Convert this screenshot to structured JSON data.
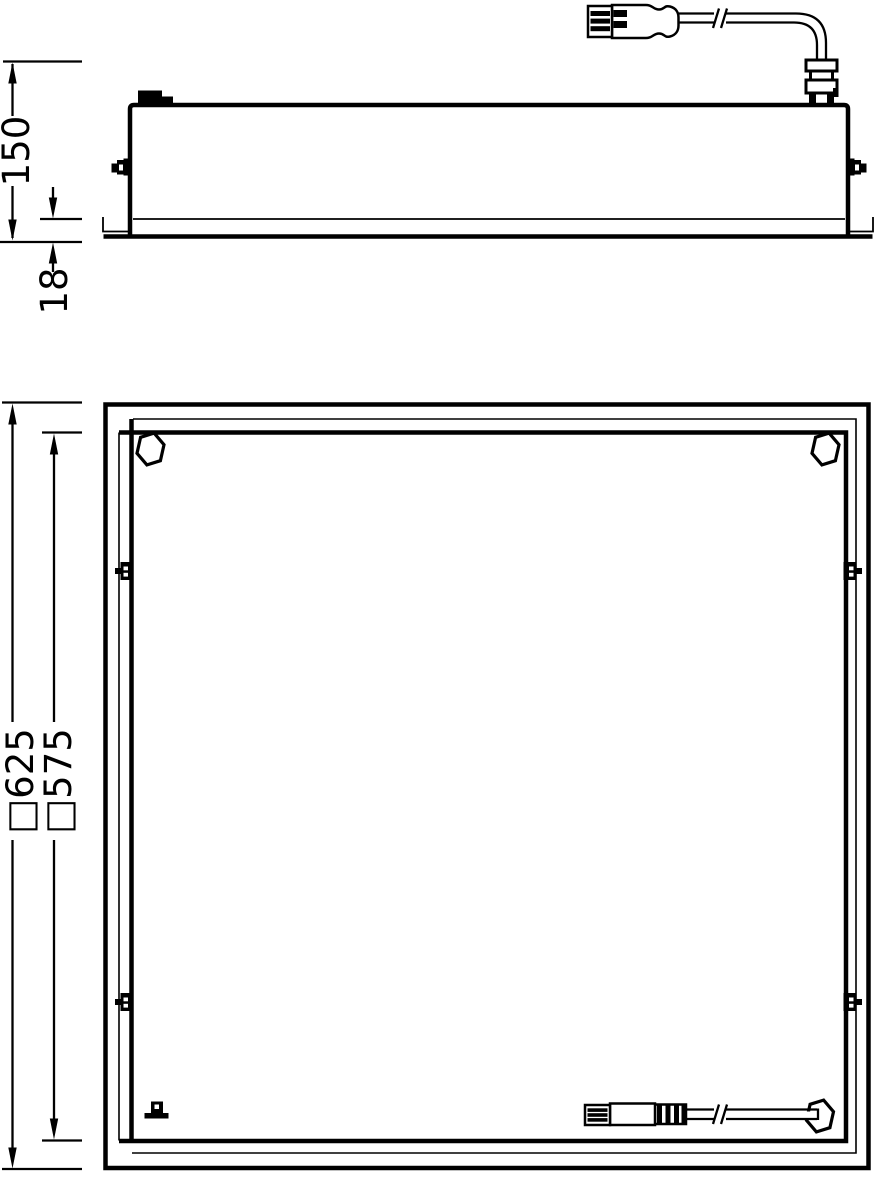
{
  "drawing": {
    "type": "luminaire-dimension-drawing",
    "colors": {
      "line": "#000000",
      "background": "#ffffff"
    },
    "side_view": {
      "height_label": "150",
      "recess_label": "18"
    },
    "plan_view": {
      "frame_label": "□625",
      "panel_label": "□575"
    }
  }
}
